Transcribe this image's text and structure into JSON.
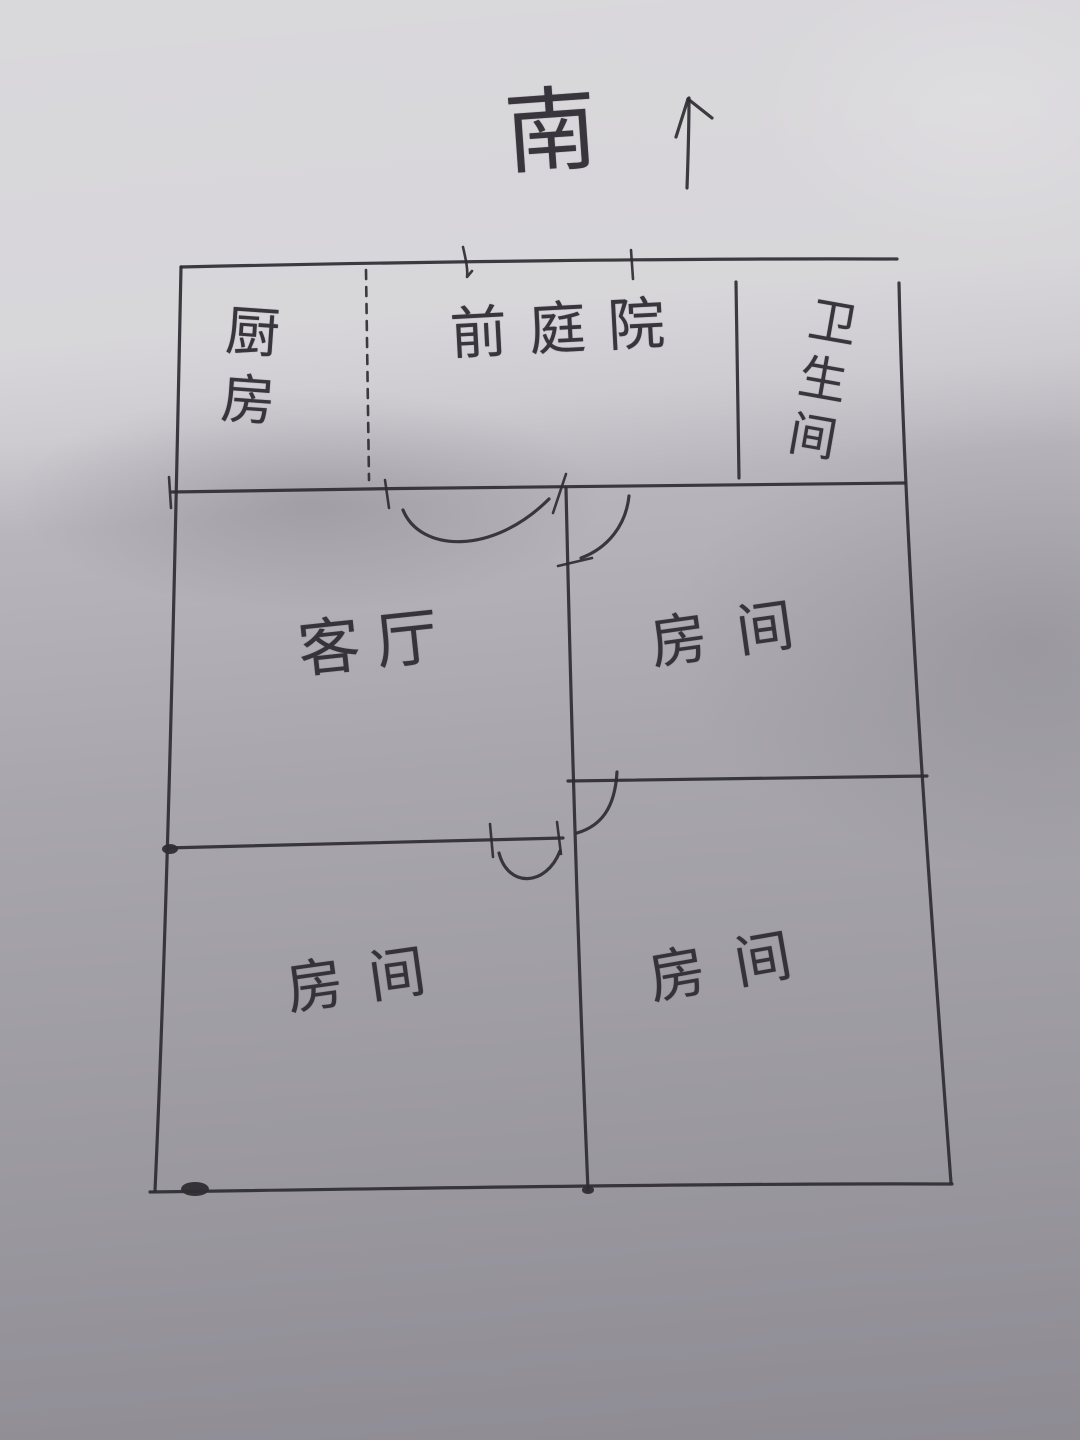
{
  "compass": {
    "label": "南",
    "arrow_icon": "up-arrow"
  },
  "rooms": {
    "kitchen": {
      "label": "厨房",
      "position": "top-left",
      "text_direction": "vertical"
    },
    "front_courtyard": {
      "label": "前庭院",
      "position": "top-center",
      "text_direction": "horizontal"
    },
    "bathroom": {
      "label": "卫生间",
      "position": "top-right",
      "text_direction": "vertical"
    },
    "living_room": {
      "label": "客厅",
      "position": "middle-left",
      "text_direction": "horizontal"
    },
    "bedroom_ne": {
      "label": "房间",
      "position": "middle-right",
      "text_direction": "horizontal"
    },
    "bedroom_sw": {
      "label": "房间",
      "position": "bottom-left",
      "text_direction": "horizontal"
    },
    "bedroom_se": {
      "label": "房间",
      "position": "bottom-right",
      "text_direction": "horizontal"
    }
  },
  "colors": {
    "ink": "#2f2d33",
    "paper": "#c9c7cc",
    "shadow": "#98969b"
  }
}
